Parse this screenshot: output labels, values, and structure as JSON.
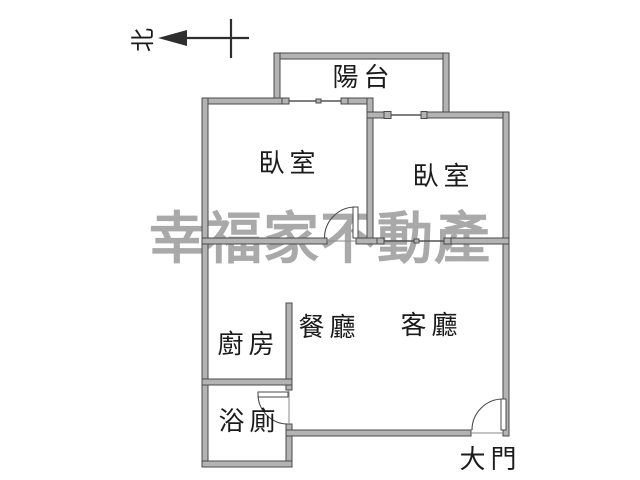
{
  "compass": {
    "label": "北",
    "direction": "arrow-points-left"
  },
  "watermark": {
    "text": "幸福家不動產"
  },
  "rooms": [
    {
      "name": "balcony",
      "label": "陽台"
    },
    {
      "name": "bedroom-left",
      "label": "臥室"
    },
    {
      "name": "bedroom-right",
      "label": "臥室"
    },
    {
      "name": "dining-room",
      "label": "餐廳"
    },
    {
      "name": "living-room",
      "label": "客廳"
    },
    {
      "name": "kitchen",
      "label": "廚房"
    },
    {
      "name": "bathroom",
      "label": "浴廁"
    }
  ],
  "doors": {
    "main_door_label": "大門"
  },
  "colors": {
    "wall-fill": "#b3b3b3",
    "wall-stroke": "#4a4a4a",
    "line": "#555555",
    "text": "#1b1b1b",
    "watermark": "#a9a9a9",
    "bg": "#ffffff"
  }
}
